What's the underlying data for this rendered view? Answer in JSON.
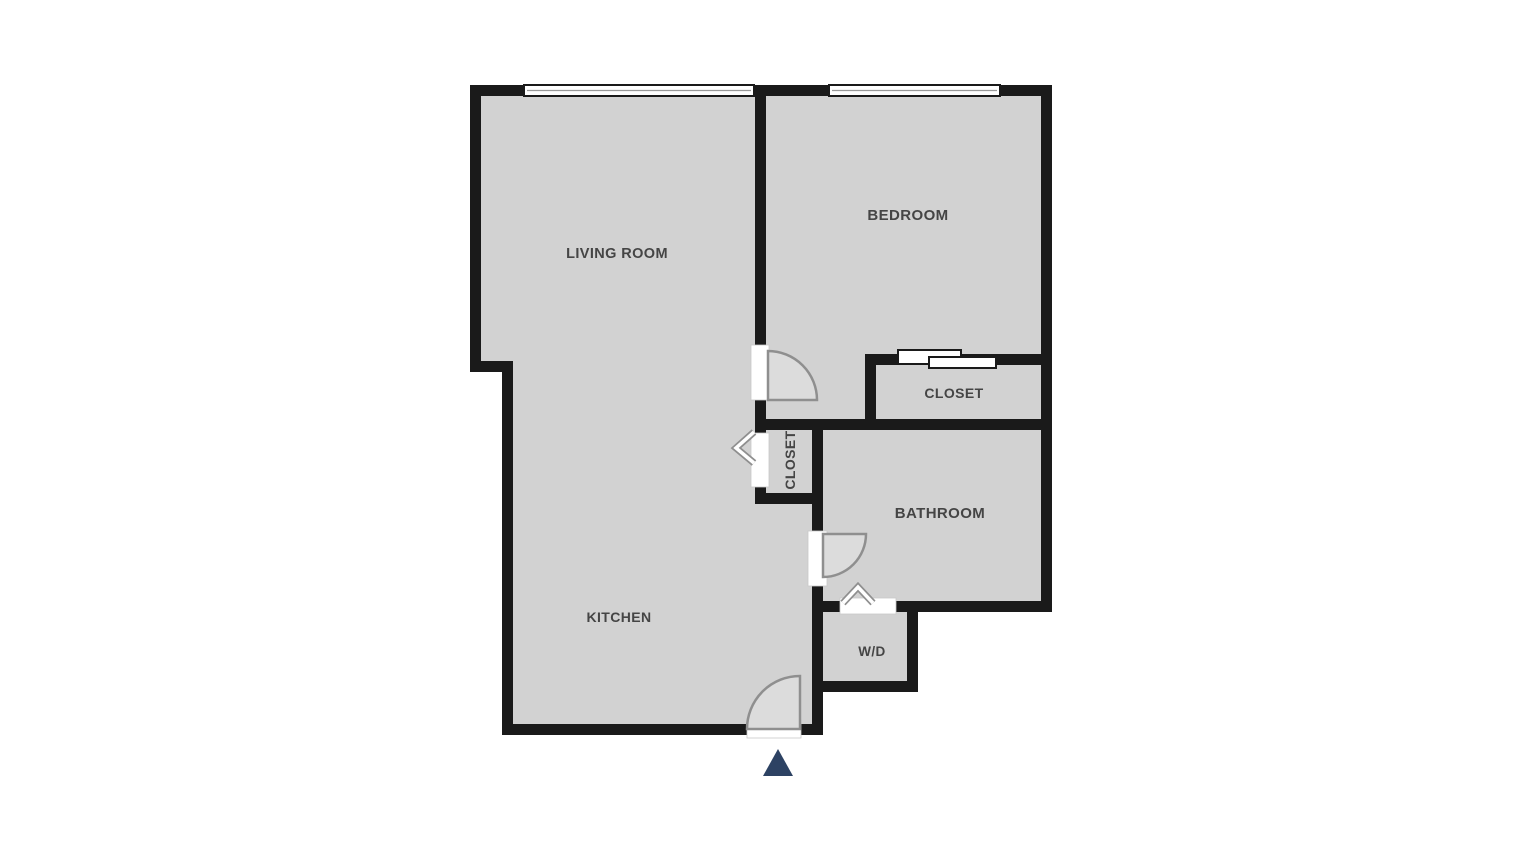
{
  "title": "Apartment floor plan",
  "colors": {
    "background": "#ffffff",
    "wall": "#1a1a1a",
    "floor": "#d2d2d2",
    "door_fill": "#dcdcdc",
    "symbol_stroke": "#8f8f8f",
    "label": "#454545",
    "entry_marker": "#2d4263"
  },
  "rooms": {
    "living_room": {
      "label": "LIVING ROOM"
    },
    "bedroom": {
      "label": "BEDROOM"
    },
    "bedroom_closet": {
      "label": "CLOSET"
    },
    "hall_closet": {
      "label": "CLOSET"
    },
    "bathroom": {
      "label": "BATHROOM"
    },
    "kitchen": {
      "label": "KITCHEN"
    },
    "washer_dryer": {
      "label": "W/D"
    }
  },
  "symbols": {
    "entry_marker": "entry-direction-triangle",
    "doors": [
      "swing-door-bedroom",
      "swing-door-bathroom",
      "swing-door-entry"
    ],
    "folding_doors": [
      "bifold-door-hall-closet",
      "bifold-door-washer-dryer"
    ],
    "sliding_doors": [
      "sliding-door-bedroom-closet"
    ],
    "windows": [
      "window-living-room",
      "window-bedroom"
    ]
  }
}
